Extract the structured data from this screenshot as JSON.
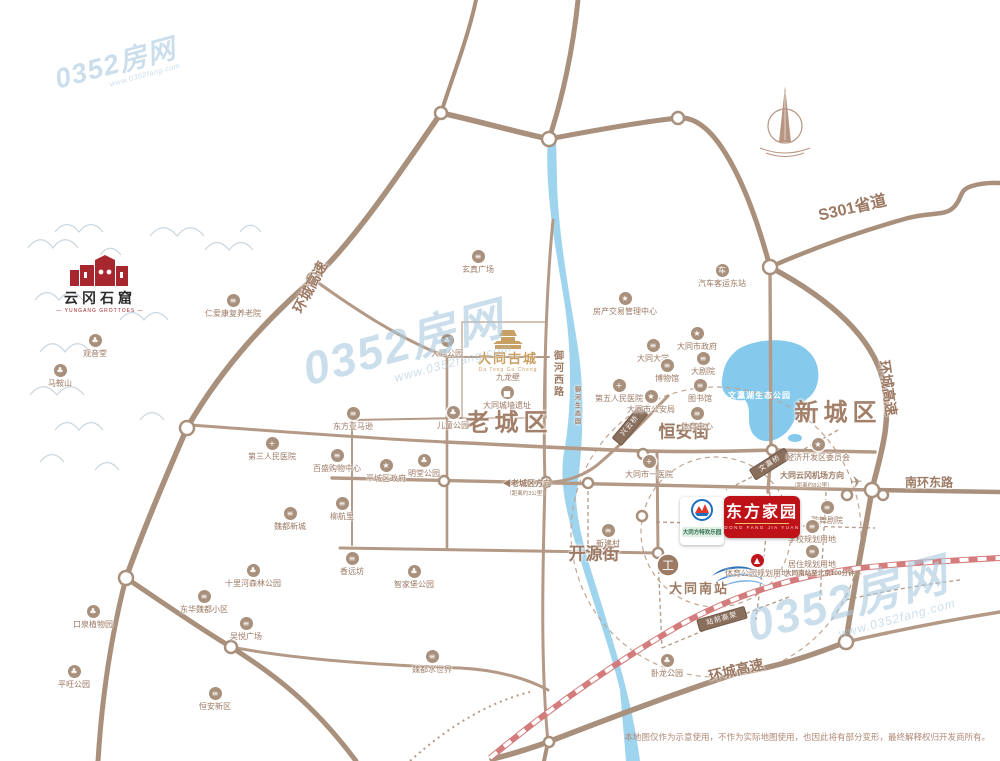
{
  "watermark": {
    "text": "0352房网",
    "url": "www.0352fang.com"
  },
  "watermarks": [
    {
      "x": 52,
      "y": 66,
      "s": 0.6
    },
    {
      "x": 298,
      "y": 348,
      "s": 1
    },
    {
      "x": 742,
      "y": 604,
      "s": 1
    }
  ],
  "logos": {
    "yungang": {
      "title": "云冈石窟",
      "subtitle": "— YUNGANG GROTTOES —"
    },
    "gucheng": {
      "title": "大同古城",
      "pinyin": "Da Tong Gu Cheng"
    },
    "dongfang": {
      "title": "东方家园",
      "pinyin": "DONG FANG JIA YUAN"
    },
    "fangte": {
      "title": "大同方特欢乐园"
    },
    "south_station": {
      "title": "大同南站"
    }
  },
  "districts": [
    {
      "label": "老城区",
      "x": 509,
      "y": 420,
      "size": 24
    },
    {
      "label": "新城区",
      "x": 838,
      "y": 410,
      "size": 24
    }
  ],
  "road_labels": [
    {
      "label": "S301省道",
      "x": 852,
      "y": 206,
      "rot": -13,
      "size": 16
    },
    {
      "label": "环城高速",
      "x": 310,
      "y": 287,
      "rot": -62,
      "size": 14
    },
    {
      "label": "环城高速",
      "x": 888,
      "y": 388,
      "rot": 82,
      "size": 14
    },
    {
      "label": "环城高速",
      "x": 736,
      "y": 670,
      "rot": -13,
      "size": 14
    },
    {
      "label": "南环东路",
      "x": 929,
      "y": 482,
      "rot": 0,
      "size": 12
    },
    {
      "label": "恒安街",
      "x": 684,
      "y": 430,
      "rot": 0,
      "size": 17
    },
    {
      "label": "开源街",
      "x": 594,
      "y": 552,
      "rot": 0,
      "size": 17
    },
    {
      "label": "御河西路",
      "x": 557,
      "y": 374,
      "rot": 0,
      "size": 10,
      "vertical": true
    },
    {
      "label": "御河生态园",
      "x": 577,
      "y": 406,
      "rot": 0,
      "size": 6,
      "vertical": true
    }
  ],
  "bridges": [
    {
      "label": "兴云桥",
      "x": 630,
      "y": 426,
      "rot": -50
    },
    {
      "label": "文瀛桥",
      "x": 770,
      "y": 464,
      "rot": -32
    },
    {
      "label": "站前高架",
      "x": 722,
      "y": 619,
      "rot": -16
    }
  ],
  "lake_label": "文瀛湖生态公园",
  "pois": [
    {
      "label": "观音堂",
      "x": 95,
      "y": 334,
      "g": "park"
    },
    {
      "label": "马鞍山",
      "x": 60,
      "y": 364,
      "g": "park"
    },
    {
      "label": "仁爱康复养老院",
      "x": 233,
      "y": 294,
      "g": "bld"
    },
    {
      "label": "玄真广场",
      "x": 478,
      "y": 250,
      "g": "bld"
    },
    {
      "label": "大同公园",
      "x": 447,
      "y": 334,
      "g": "park"
    },
    {
      "label": "儿童公园",
      "x": 453,
      "y": 406,
      "g": "park"
    },
    {
      "label": "东方亚马逊",
      "x": 353,
      "y": 407,
      "g": "bld"
    },
    {
      "label": "第三人民医院",
      "x": 272,
      "y": 437,
      "g": "hosp"
    },
    {
      "label": "百盛购物中心",
      "x": 337,
      "y": 449,
      "g": "bld"
    },
    {
      "label": "明堂公园",
      "x": 424,
      "y": 454,
      "g": "park"
    },
    {
      "label": "平城区政府",
      "x": 386,
      "y": 459,
      "g": "gov"
    },
    {
      "label": "柳航里",
      "x": 342,
      "y": 497,
      "g": "bld"
    },
    {
      "label": "魏都新城",
      "x": 290,
      "y": 507,
      "g": "bld"
    },
    {
      "label": "香远坊",
      "x": 352,
      "y": 552,
      "g": "bld"
    },
    {
      "label": "智家堡公园",
      "x": 414,
      "y": 565,
      "g": "park"
    },
    {
      "label": "十里河森林公园",
      "x": 253,
      "y": 564,
      "g": "park"
    },
    {
      "label": "东华魏都小区",
      "x": 204,
      "y": 590,
      "g": "bld"
    },
    {
      "label": "吴悦广场",
      "x": 246,
      "y": 617,
      "g": "bld"
    },
    {
      "label": "口泉植物园",
      "x": 93,
      "y": 605,
      "g": "park"
    },
    {
      "label": "平旺公园",
      "x": 74,
      "y": 665,
      "g": "park"
    },
    {
      "label": "恒安新区",
      "x": 215,
      "y": 687,
      "g": "bld"
    },
    {
      "label": "魏都水世界",
      "x": 432,
      "y": 650,
      "g": "bld"
    },
    {
      "label": "卧龙公园",
      "x": 667,
      "y": 654,
      "g": "park"
    },
    {
      "label": "汽车客运东站",
      "x": 722,
      "y": 264,
      "g": "bus"
    },
    {
      "label": "房产交易管理中心",
      "x": 625,
      "y": 292,
      "g": "gov",
      "wrap": 66
    },
    {
      "label": "大同市政府",
      "x": 697,
      "y": 327,
      "g": "gov"
    },
    {
      "label": "大同大学",
      "x": 653,
      "y": 339,
      "g": "bld"
    },
    {
      "label": "博物馆",
      "x": 667,
      "y": 359,
      "g": "bld"
    },
    {
      "label": "大剧院",
      "x": 703,
      "y": 352,
      "g": "bld"
    },
    {
      "label": "图书馆",
      "x": 700,
      "y": 379,
      "g": "bld"
    },
    {
      "label": "第五人民医院",
      "x": 619,
      "y": 379,
      "g": "hosp",
      "wrap": 56
    },
    {
      "label": "大同市公安局",
      "x": 651,
      "y": 390,
      "g": "gov",
      "wrap": 56
    },
    {
      "label": "体育中心",
      "x": 697,
      "y": 407,
      "g": "bld"
    },
    {
      "label": "大同市一医院",
      "x": 649,
      "y": 455,
      "g": "hosp"
    },
    {
      "label": "经济开发区委员会",
      "x": 818,
      "y": 438,
      "g": "gov",
      "wrap": 66
    },
    {
      "label": "歌舞剧院",
      "x": 827,
      "y": 501,
      "g": "bld"
    },
    {
      "label": "学校规划用地",
      "x": 812,
      "y": 520,
      "g": "bld",
      "wrap": 48
    },
    {
      "label": "居住规划用地",
      "x": 812,
      "y": 545,
      "g": "bld",
      "wrap": 48
    },
    {
      "label": "新建村",
      "x": 608,
      "y": 524,
      "g": "bld"
    },
    {
      "label": "九龙壁",
      "x": 508,
      "y": 371,
      "g": "none"
    },
    {
      "label": "大同城墙遗址",
      "x": 507,
      "y": 386,
      "g": "wall"
    },
    {
      "label": "体育公园规划用地",
      "x": 757,
      "y": 554,
      "g": "stadium"
    }
  ],
  "notes": [
    {
      "label": "◀老城区方向",
      "sub": "（距离约3公里）",
      "x": 527,
      "y": 478,
      "size": 8
    },
    {
      "label": "大同云冈机场方向",
      "sub": "（距离约8公里）",
      "x": 812,
      "y": 470,
      "size": 8,
      "icon": "✈",
      "ix": 850,
      "iy": 473
    },
    {
      "label": "大同南站至北京100分钟 →",
      "x": 824,
      "y": 567,
      "size": 6.5
    }
  ],
  "disclaimer": "本地图仅作为示意使用，不作为实际地图使用，也因此将有部分变形，最终解释权归开发商所有。",
  "colors": {
    "road": "#a8907c",
    "road_light": "#c3ab99",
    "river": "#9fd4ee",
    "lake": "#85c9ec",
    "label": "#9c7a64",
    "brand_red": "#bf1218",
    "rail": "#d47c7c",
    "watermark": "#a9c9df"
  }
}
